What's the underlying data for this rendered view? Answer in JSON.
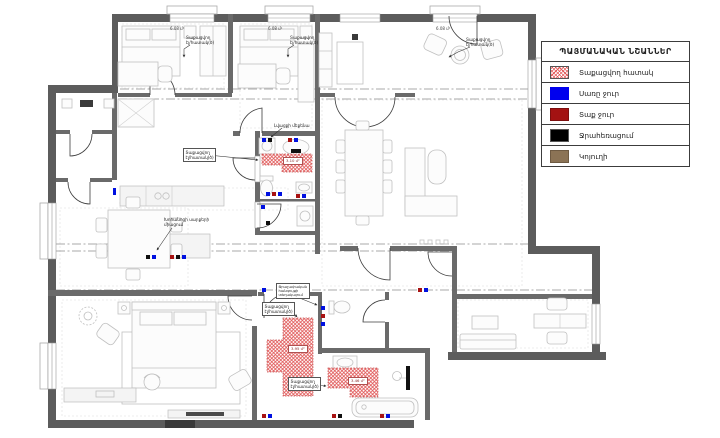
{
  "legend": {
    "title": "ՊԱՅՄԱՆԱԿԱՆ ՆՇԱՆՆԵՐ",
    "items": [
      {
        "label": "Տաքացվող հատակ",
        "swatch": "red-hatch",
        "color": "#e25555"
      },
      {
        "label": "Սառը ջուր",
        "swatch": "solid",
        "color": "#0000ee"
      },
      {
        "label": "Տաք ջուր",
        "swatch": "solid",
        "color": "#a31212"
      },
      {
        "label": "Ջրահեռացում",
        "swatch": "solid",
        "color": "#000000"
      },
      {
        "label": "Կոյուղի",
        "swatch": "solid",
        "color": "#8b7355"
      }
    ]
  },
  "areas": {
    "bedroom1": "6.08 մ²",
    "bedroom2": "6.08 մ²",
    "living": "6.08 մ²"
  },
  "heated_zones": {
    "bath1": "3.10 մ²",
    "bath2": "3.95 մ²",
    "bath3": "3.46 մ²"
  },
  "notes": {
    "heated_floor": [
      "Տաքացվող",
      "էլ/հատակ(ծ)"
    ],
    "washer": "Լվացքի մեքենա",
    "kitchen": [
      "Խոհանոցի սարքերի",
      "միացում"
    ],
    "meter": [
      "Ջրաչափական",
      "հանգույցի",
      "տեղակայում"
    ]
  }
}
